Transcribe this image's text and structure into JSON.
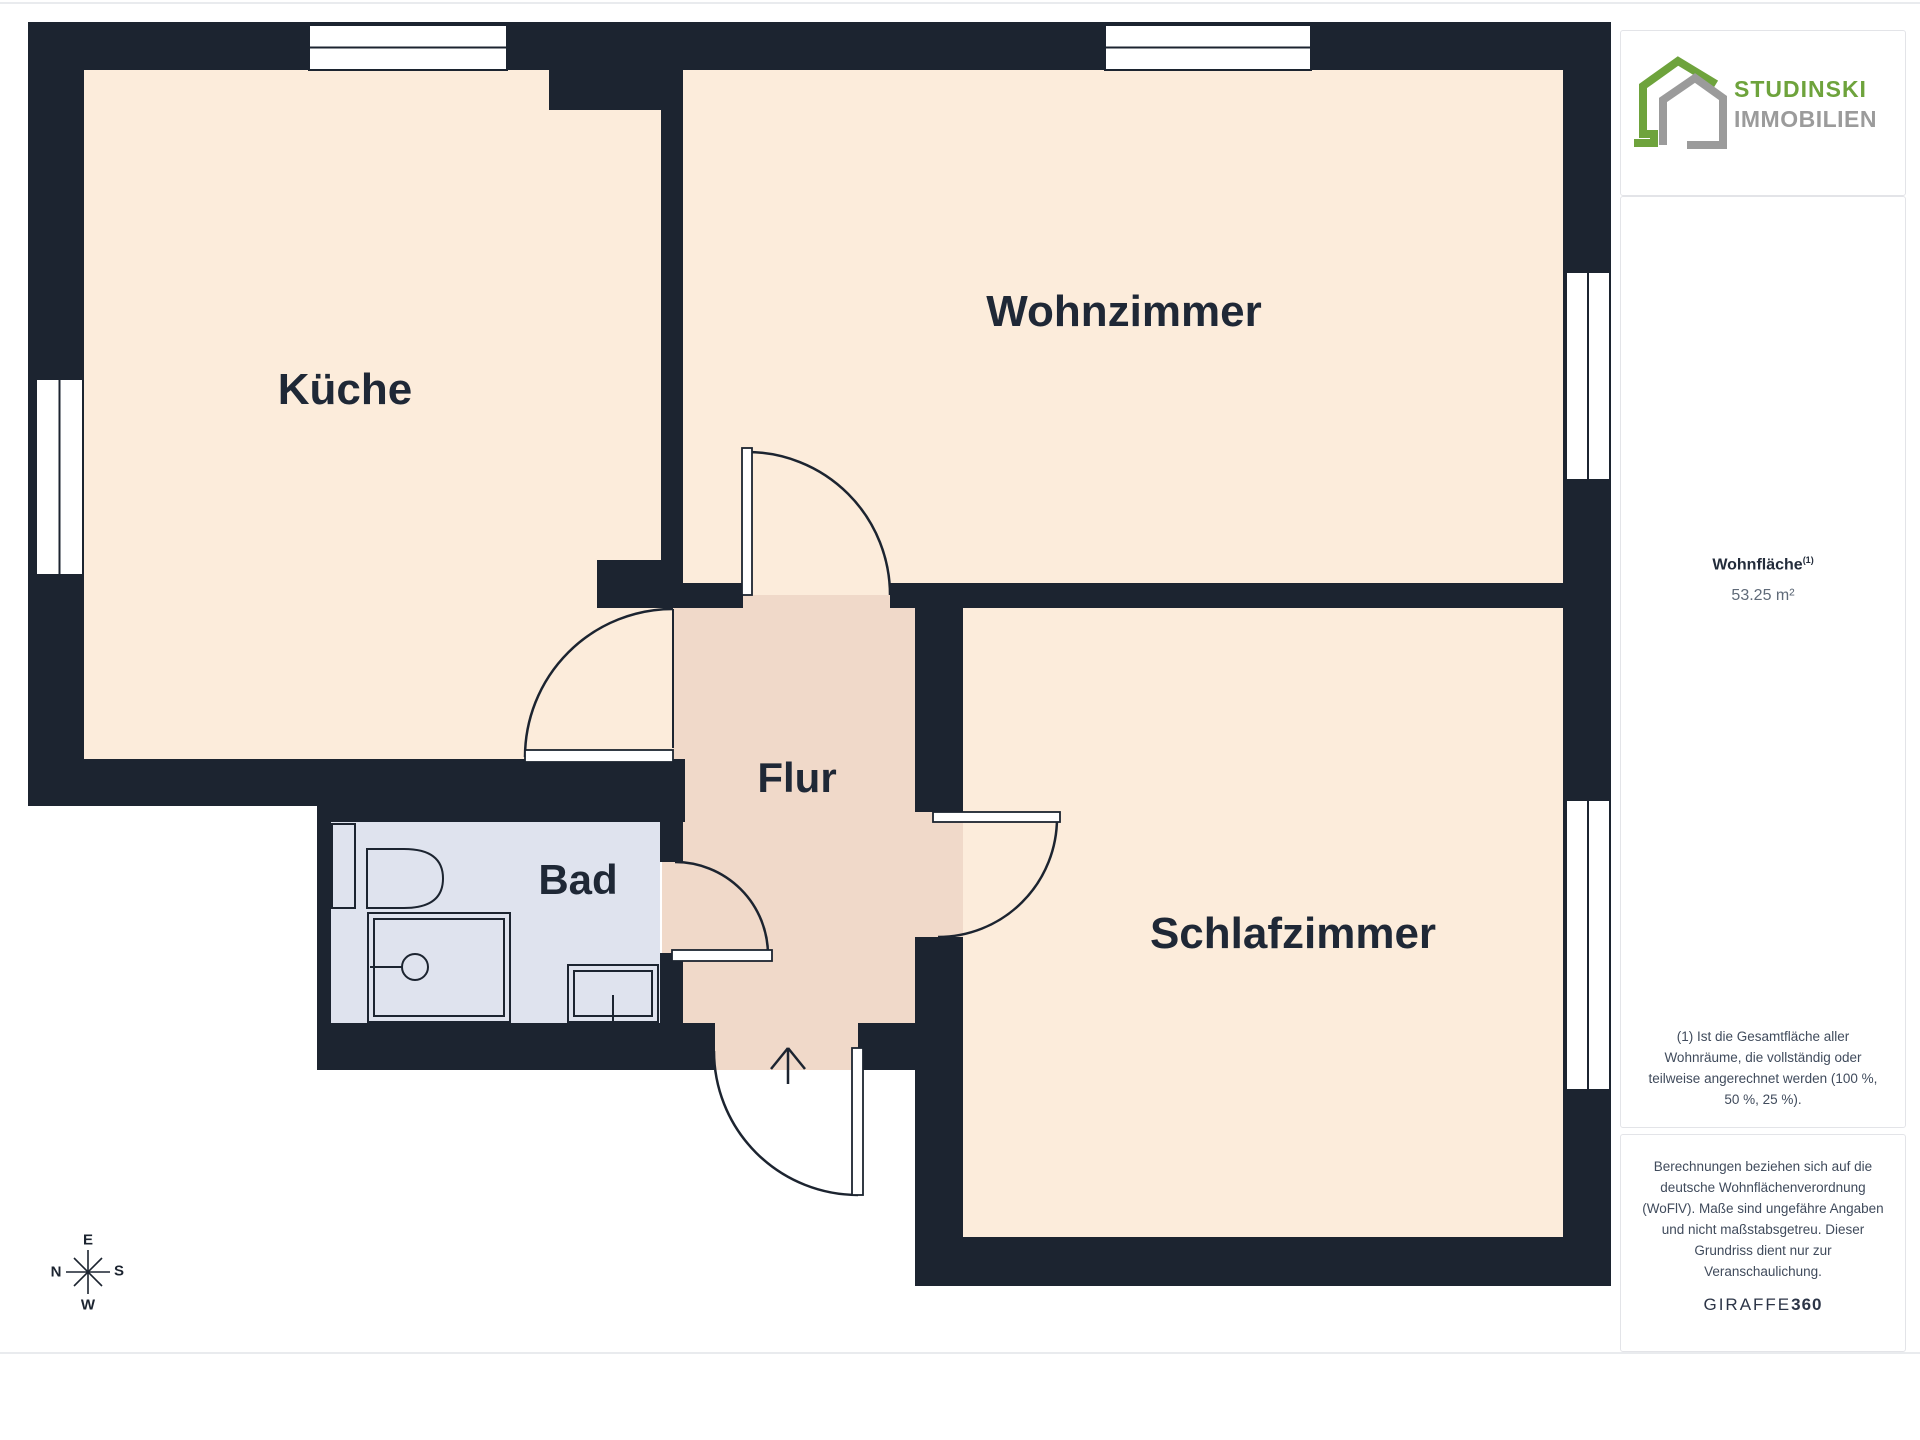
{
  "colors": {
    "wall": "#1c2430",
    "room_fill": "#fcecdb",
    "hall_fill": "#f0d9c9",
    "bath_fill": "#dfe3ee",
    "brand_green": "#6ea33c",
    "brand_gray": "#9b9b9b",
    "text_dark": "#232c3b"
  },
  "rooms": {
    "kueche": "Küche",
    "wohnzimmer": "Wohnzimmer",
    "schlafzimmer": "Schlafzimmer",
    "flur": "Flur",
    "bad": "Bad"
  },
  "compass": {
    "top": "E",
    "left": "N",
    "right": "S",
    "bottom": "W"
  },
  "sidebar": {
    "logo_line1": "STUDINSKI",
    "logo_line2": "IMMOBILIEN",
    "area_label": "Wohnfläche",
    "area_sup": "(1)",
    "area_value": "53.25 m²",
    "footnote": "(1) Ist die Gesamtfläche aller Wohnräume, die vollständig oder teilweise angerechnet werden (100 %, 50 %, 25 %).",
    "disclaimer": "Berechnungen beziehen sich auf die deutsche Wohnflächenverordnung (WoFlV). Maße sind ungefähre Angaben und nicht maßstabsgetreu. Dieser Grundriss dient nur zur Veranschaulichung.",
    "brand": "GIRAFFE",
    "brand_suffix": "360"
  }
}
